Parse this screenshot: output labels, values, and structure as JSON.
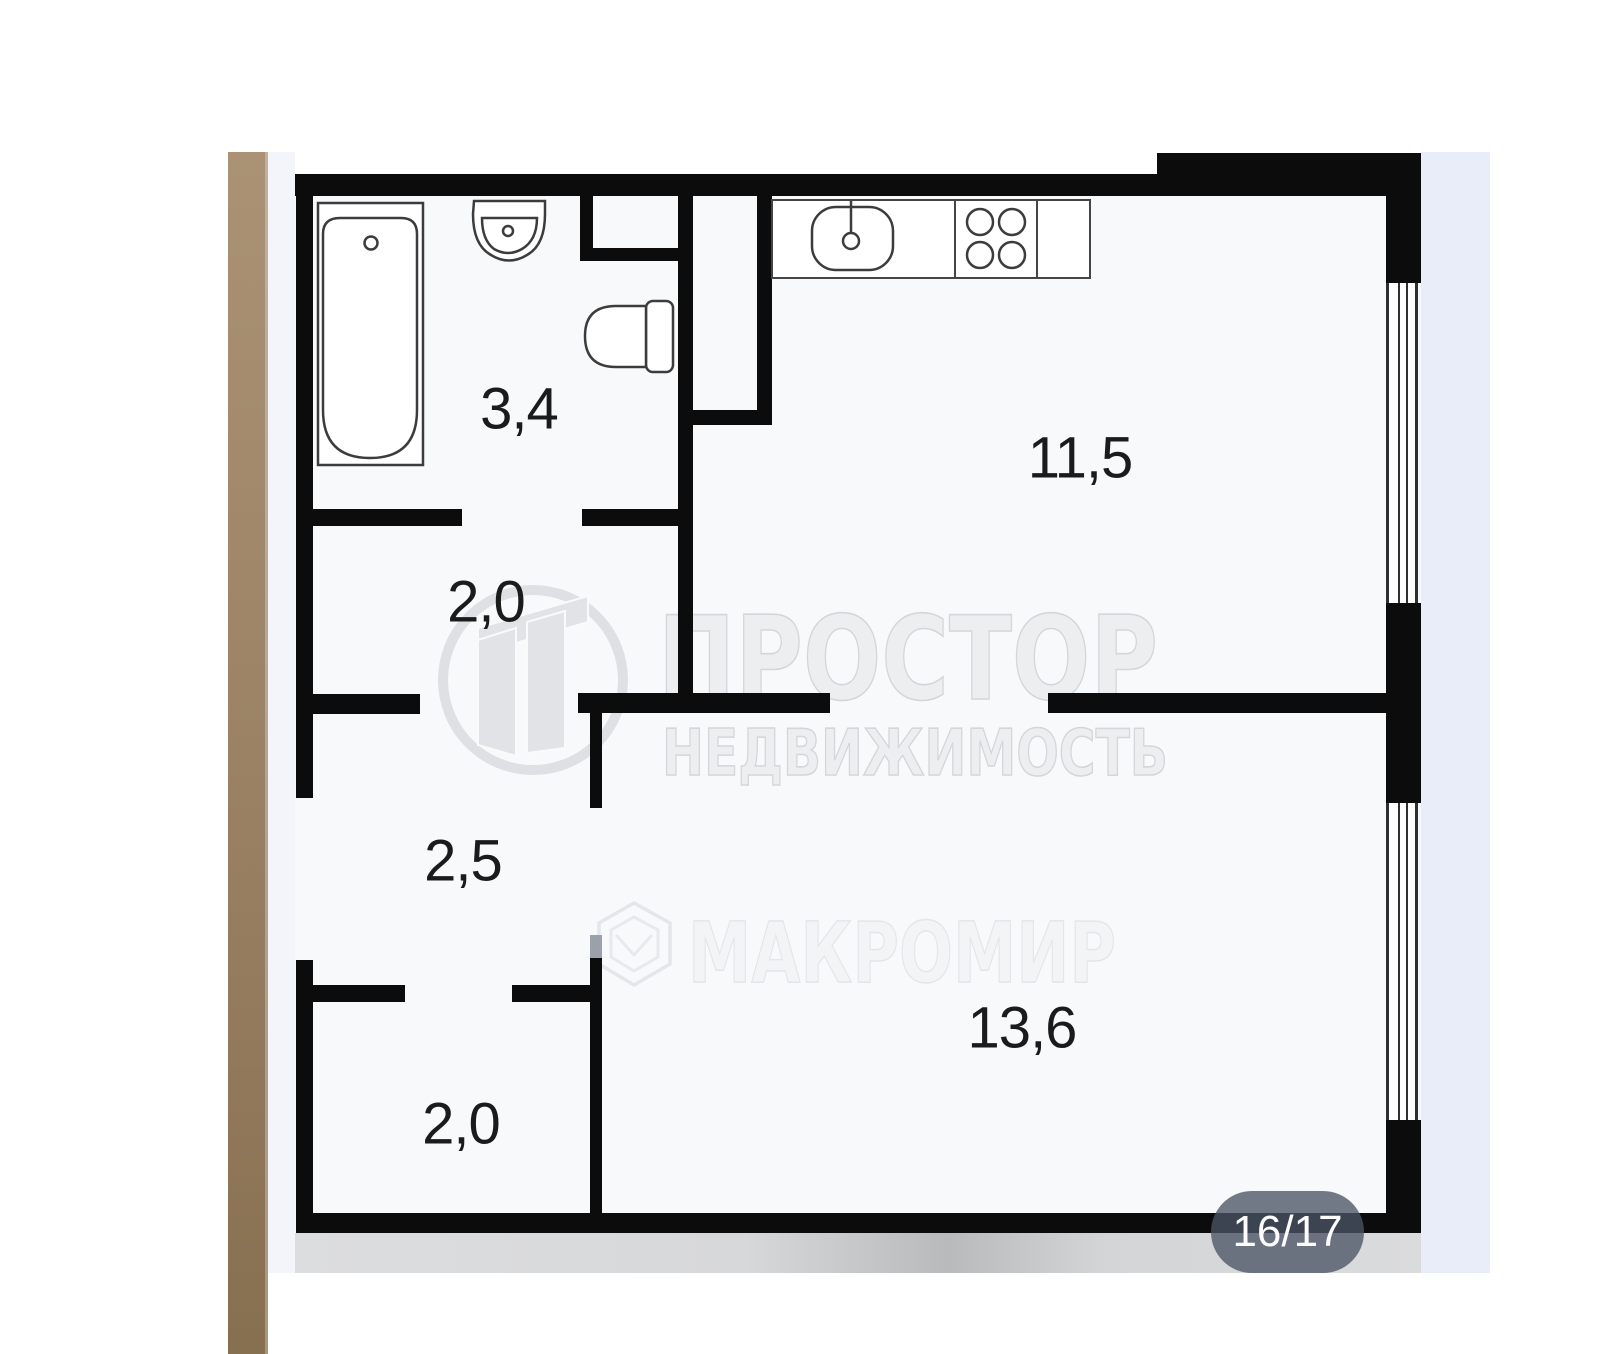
{
  "page": {
    "type": "real-estate floor plan photo"
  },
  "floorplan": {
    "rooms": [
      {
        "name": "bathroom",
        "area": "3,4"
      },
      {
        "name": "kitchen",
        "area": "11,5"
      },
      {
        "name": "hallway-upper",
        "area": "2,0"
      },
      {
        "name": "hallway-middle",
        "area": "2,5"
      },
      {
        "name": "hallway-lower",
        "area": "2,0"
      },
      {
        "name": "living-room",
        "area": "13,6"
      }
    ]
  },
  "watermarks": {
    "agency_name": "ПРОСТОР",
    "agency_subtitle": "НЕДВИЖИМОСТЬ",
    "developer_name": "МАКРОМИР"
  },
  "pager": {
    "label": "16/17"
  },
  "colors": {
    "wall": "#0c0c0c",
    "adjacent_photo_brown": "#9d8466",
    "right_strip": "#e9edf9",
    "gray_band": "#d7d8da",
    "badge_bg": "rgba(76,84,101,0.78)"
  }
}
